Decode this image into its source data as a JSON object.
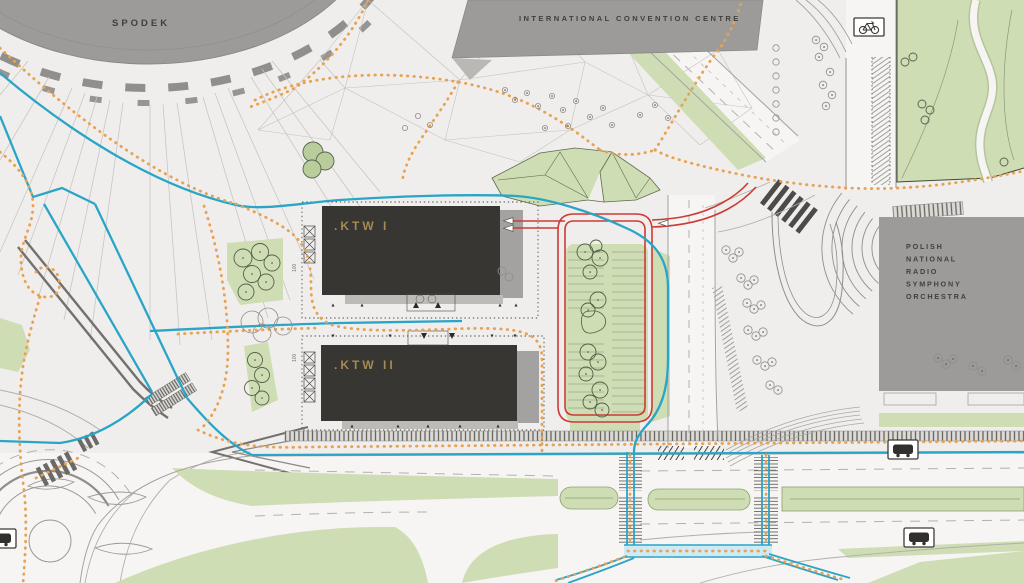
{
  "labels": {
    "spodek": "SPODEK",
    "convention_centre": "INTERNATIONAL CONVENTION CENTRE",
    "ktw1": ".KTW I",
    "ktw2": ".KTW II",
    "nospr_lines": [
      "POLISH",
      "NATIONAL",
      "RADIO",
      "SYMPHONY",
      "ORCHESTRA"
    ],
    "dimension_marker": "100"
  },
  "legend": {
    "colors": {
      "background": "#f0eeec",
      "road_fill": "#f6f5f3",
      "building_gray": "#9c9b99",
      "building_dark": "#383633",
      "ktw_label_gold": "#a58a52",
      "green_area": "#cfddb5",
      "cycle_route_blue": "#2aa5c7",
      "pedestrian_route_orange": "#e7a254",
      "car_route_red": "#ce3a34"
    }
  },
  "icons": {
    "bicycle_parking": "bicycle-icon",
    "bus_stop": "bus-icon"
  }
}
